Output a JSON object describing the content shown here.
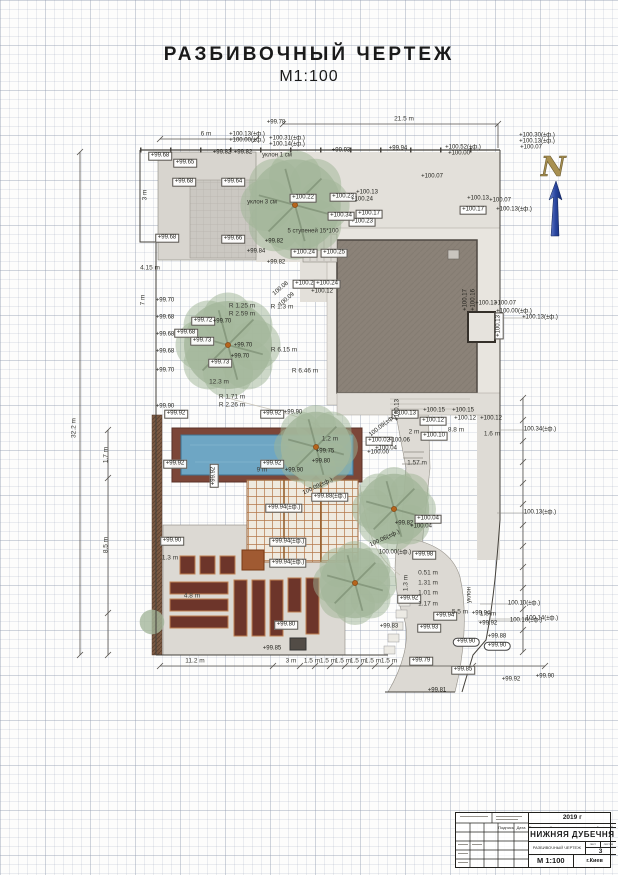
{
  "page": {
    "title_line1": "РАЗБИВОЧНЫЙ  ЧЕРТЕЖ",
    "title_line2": "М1:100"
  },
  "north": {
    "letter": "N"
  },
  "title_block": {
    "year": "2019 г",
    "project": "Благоустройство территории частной усадьбы",
    "object_name": "НИЖНЯЯ ДУБЕЧНЯ",
    "drawing_title": "РАЗБИВОЧНЫЙ ЧЕРТЕЖ",
    "sheet_label": "лист",
    "sheets_label": "листов",
    "sheet_number": "3",
    "scale": "М 1:100",
    "city": "г.Киев",
    "signature_label": "Подпись",
    "date_label": "Дата"
  },
  "trees": [
    {
      "x": 295,
      "y": 205,
      "r": 52
    },
    {
      "x": 228,
      "y": 345,
      "r": 50
    },
    {
      "x": 316,
      "y": 447,
      "r": 40
    },
    {
      "x": 394,
      "y": 509,
      "r": 40
    },
    {
      "x": 355,
      "y": 583,
      "r": 40
    },
    {
      "x": 152,
      "y": 622,
      "r": 14
    }
  ],
  "annotations": [
    {
      "t": "+99.68",
      "x": 160,
      "y": 156,
      "b": 1
    },
    {
      "t": "+99.65",
      "x": 185,
      "y": 163,
      "b": 1
    },
    {
      "t": "+99.68",
      "x": 184,
      "y": 182,
      "b": 1
    },
    {
      "t": "+99.64",
      "x": 233,
      "y": 182,
      "b": 1
    },
    {
      "t": "+99.68",
      "x": 167,
      "y": 238,
      "b": 1
    },
    {
      "t": "+99.66",
      "x": 233,
      "y": 239,
      "b": 1
    },
    {
      "t": "+99.82",
      "x": 222,
      "y": 153
    },
    {
      "t": "+99.82",
      "x": 243,
      "y": 153
    },
    {
      "t": "+99.78",
      "x": 276,
      "y": 123
    },
    {
      "t": "+99.82",
      "x": 274,
      "y": 242
    },
    {
      "t": "+99.84",
      "x": 256,
      "y": 252
    },
    {
      "t": "+99.82",
      "x": 276,
      "y": 263
    },
    {
      "t": "+100.13(±ф.)",
      "x": 247,
      "y": 135
    },
    {
      "t": "+100.00(±ф.)",
      "x": 247,
      "y": 141
    },
    {
      "t": "+100.31(±ф.)",
      "x": 287,
      "y": 139
    },
    {
      "t": "+100.14(±ф.)",
      "x": 287,
      "y": 145
    },
    {
      "t": "+99.93",
      "x": 341,
      "y": 151
    },
    {
      "t": "+99.94",
      "x": 398,
      "y": 149
    },
    {
      "t": "+100.52(±ф.)",
      "x": 463,
      "y": 148
    },
    {
      "t": "+100.00",
      "x": 459,
      "y": 154
    },
    {
      "t": "+100.30(±ф.)",
      "x": 537,
      "y": 136
    },
    {
      "t": "+100.13(±ф.)",
      "x": 537,
      "y": 142
    },
    {
      "t": "+100.07",
      "x": 531,
      "y": 148
    },
    {
      "t": "+100.22",
      "x": 303,
      "y": 198,
      "b": 1
    },
    {
      "t": "+100.23",
      "x": 343,
      "y": 197,
      "b": 1
    },
    {
      "t": "+100.13",
      "x": 367,
      "y": 193
    },
    {
      "t": "+100.24",
      "x": 362,
      "y": 200
    },
    {
      "t": "+100.17",
      "x": 369,
      "y": 214,
      "b": 1
    },
    {
      "t": "+100.23",
      "x": 362,
      "y": 222,
      "b": 1
    },
    {
      "t": "+100.34",
      "x": 341,
      "y": 216,
      "b": 1
    },
    {
      "t": "+100.24",
      "x": 304,
      "y": 253,
      "b": 1
    },
    {
      "t": "+100.25",
      "x": 334,
      "y": 253,
      "b": 1
    },
    {
      "t": "+100.07",
      "x": 432,
      "y": 177
    },
    {
      "t": "+100.13",
      "x": 478,
      "y": 199
    },
    {
      "t": "+100.07",
      "x": 500,
      "y": 201
    },
    {
      "t": "+100.17",
      "x": 473,
      "y": 210,
      "b": 1
    },
    {
      "t": "+100.13(±ф.)",
      "x": 514,
      "y": 210
    },
    {
      "t": "+100.13",
      "x": 486,
      "y": 304
    },
    {
      "t": "+100.07",
      "x": 505,
      "y": 304
    },
    {
      "t": "+100.00(±ф.)",
      "x": 514,
      "y": 312
    },
    {
      "t": "+100.17",
      "x": 466,
      "y": 300,
      "r": -90
    },
    {
      "t": "+100.16",
      "x": 474,
      "y": 300,
      "r": -90
    },
    {
      "t": "+100.13",
      "x": 499,
      "y": 326,
      "r": -90,
      "b": 1
    },
    {
      "t": "+100.13(±ф.)",
      "x": 540,
      "y": 318
    },
    {
      "t": "+99.70",
      "x": 165,
      "y": 301
    },
    {
      "t": "+99.68",
      "x": 165,
      "y": 318
    },
    {
      "t": "+99.68",
      "x": 165,
      "y": 335
    },
    {
      "t": "+99.68",
      "x": 165,
      "y": 352
    },
    {
      "t": "+99.70",
      "x": 165,
      "y": 371
    },
    {
      "t": "+99.72",
      "x": 203,
      "y": 321,
      "b": 1
    },
    {
      "t": "+99.70",
      "x": 222,
      "y": 322
    },
    {
      "t": "+99.68",
      "x": 186,
      "y": 333,
      "b": 1
    },
    {
      "t": "+99.73",
      "x": 202,
      "y": 341,
      "b": 1
    },
    {
      "t": "+99.70",
      "x": 243,
      "y": 346
    },
    {
      "t": "+99.70",
      "x": 240,
      "y": 357
    },
    {
      "t": "+99.73",
      "x": 220,
      "y": 363,
      "b": 1
    },
    {
      "t": "+99.90",
      "x": 165,
      "y": 407
    },
    {
      "t": "+100.23",
      "x": 306,
      "y": 284,
      "b": 1
    },
    {
      "t": "+100.24",
      "x": 327,
      "y": 284,
      "b": 1
    },
    {
      "t": "+100.12",
      "x": 322,
      "y": 292
    },
    {
      "t": "100.08",
      "x": 281,
      "y": 289,
      "r": -40
    },
    {
      "t": "100.09",
      "x": 287,
      "y": 300,
      "r": -40
    },
    {
      "t": "+100.13",
      "x": 405,
      "y": 414,
      "b": 1
    },
    {
      "t": "+100.15",
      "x": 434,
      "y": 411
    },
    {
      "t": "+100.15",
      "x": 463,
      "y": 411
    },
    {
      "t": "+100.12",
      "x": 433,
      "y": 421,
      "b": 1
    },
    {
      "t": "+100.12",
      "x": 465,
      "y": 419
    },
    {
      "t": "+100.12",
      "x": 491,
      "y": 419
    },
    {
      "t": "+100.13",
      "x": 398,
      "y": 410,
      "r": -90
    },
    {
      "t": "+100.10",
      "x": 434,
      "y": 436,
      "b": 1
    },
    {
      "t": "+100.02",
      "x": 379,
      "y": 441,
      "b": 1
    },
    {
      "t": "+100.06",
      "x": 399,
      "y": 441
    },
    {
      "t": "+100.04",
      "x": 386,
      "y": 449
    },
    {
      "t": "+100.00",
      "x": 378,
      "y": 453
    },
    {
      "t": "100.09(±ф.)",
      "x": 383,
      "y": 426,
      "r": -38
    },
    {
      "t": "100.09(±ф.)",
      "x": 318,
      "y": 487,
      "r": -25
    },
    {
      "t": "+99.75",
      "x": 325,
      "y": 452
    },
    {
      "t": "+99.80",
      "x": 321,
      "y": 462
    },
    {
      "t": "+99.90",
      "x": 294,
      "y": 471
    },
    {
      "t": "+99.88(±ф.)",
      "x": 330,
      "y": 497,
      "b": 1
    },
    {
      "t": "+99.94(±ф.)",
      "x": 284,
      "y": 508,
      "b": 1
    },
    {
      "t": "+99.94(±ф.)",
      "x": 288,
      "y": 542,
      "b": 1
    },
    {
      "t": "+99.94(±ф.)",
      "x": 288,
      "y": 563,
      "b": 1
    },
    {
      "t": "+99.82",
      "x": 404,
      "y": 524
    },
    {
      "t": "100.06(±ф.)",
      "x": 385,
      "y": 539,
      "r": -25
    },
    {
      "t": "+100.04",
      "x": 428,
      "y": 519,
      "b": 1
    },
    {
      "t": "+100.04",
      "x": 421,
      "y": 527
    },
    {
      "t": "100.34(±ф.)",
      "x": 540,
      "y": 430
    },
    {
      "t": "100.13(±ф.)",
      "x": 540,
      "y": 513
    },
    {
      "t": "100.14(±ф.)",
      "x": 542,
      "y": 619
    },
    {
      "t": "100.10(±ф.)",
      "x": 524,
      "y": 604
    },
    {
      "t": "100.16(±ф.)",
      "x": 526,
      "y": 621
    },
    {
      "t": "+99.92",
      "x": 176,
      "y": 414,
      "b": 1
    },
    {
      "t": "+99.92",
      "x": 272,
      "y": 414,
      "b": 1
    },
    {
      "t": "+99.90",
      "x": 293,
      "y": 413
    },
    {
      "t": "+99.92",
      "x": 175,
      "y": 464,
      "b": 1
    },
    {
      "t": "+99.92",
      "x": 272,
      "y": 464,
      "b": 1
    },
    {
      "t": "+99.92",
      "x": 214,
      "y": 476,
      "r": -90,
      "b": 1
    },
    {
      "t": "+99.90",
      "x": 172,
      "y": 541,
      "b": 1
    },
    {
      "t": "+99.80",
      "x": 286,
      "y": 625,
      "b": 1
    },
    {
      "t": "+99.85",
      "x": 272,
      "y": 649
    },
    {
      "t": "100.00(±ф.)",
      "x": 395,
      "y": 553
    },
    {
      "t": "+99.98",
      "x": 424,
      "y": 555,
      "b": 1
    },
    {
      "t": "+99.92",
      "x": 409,
      "y": 599,
      "b": 1
    },
    {
      "t": "+99.83",
      "x": 389,
      "y": 627
    },
    {
      "t": "+99.94",
      "x": 445,
      "y": 616,
      "b": 1
    },
    {
      "t": "+99.94",
      "x": 481,
      "y": 614
    },
    {
      "t": "+99.92",
      "x": 488,
      "y": 624
    },
    {
      "t": "+99.93",
      "x": 429,
      "y": 628,
      "b": 1
    },
    {
      "t": "+99.90",
      "x": 466,
      "y": 642,
      "p": 1
    },
    {
      "t": "+99.88",
      "x": 497,
      "y": 637
    },
    {
      "t": "+99.90",
      "x": 497,
      "y": 646,
      "p": 1
    },
    {
      "t": "+99.85",
      "x": 463,
      "y": 670,
      "b": 1
    },
    {
      "t": "+99.92",
      "x": 511,
      "y": 680
    },
    {
      "t": "+99.79",
      "x": 421,
      "y": 661,
      "b": 1
    },
    {
      "t": "+99.81",
      "x": 437,
      "y": 691
    },
    {
      "t": "+99.90",
      "x": 545,
      "y": 677
    },
    {
      "t": "21.5 m",
      "x": 404,
      "y": 119,
      "k": "d"
    },
    {
      "t": "6 m",
      "x": 206,
      "y": 134,
      "k": "d"
    },
    {
      "t": "32.2 m",
      "x": 74,
      "y": 428,
      "k": "d",
      "r": -90
    },
    {
      "t": "4.15 m",
      "x": 150,
      "y": 268,
      "k": "d"
    },
    {
      "t": "7 m",
      "x": 143,
      "y": 300,
      "k": "d",
      "r": -90
    },
    {
      "t": "3 m",
      "x": 145,
      "y": 195,
      "k": "d",
      "r": -90
    },
    {
      "t": "12.3 m",
      "x": 219,
      "y": 382,
      "k": "d"
    },
    {
      "t": "R 1.25 m",
      "x": 242,
      "y": 306,
      "k": "d"
    },
    {
      "t": "R 2.59 m",
      "x": 242,
      "y": 314,
      "k": "d"
    },
    {
      "t": "R 1.3 m",
      "x": 282,
      "y": 307,
      "k": "d"
    },
    {
      "t": "R 6.15 m",
      "x": 284,
      "y": 350,
      "k": "d"
    },
    {
      "t": "R 6.46 m",
      "x": 305,
      "y": 371,
      "k": "d"
    },
    {
      "t": "R 1.71 m",
      "x": 232,
      "y": 397,
      "k": "d"
    },
    {
      "t": "R 2.26 m",
      "x": 232,
      "y": 405,
      "k": "d"
    },
    {
      "t": "9 m",
      "x": 262,
      "y": 470,
      "k": "d"
    },
    {
      "t": "1.2 m",
      "x": 330,
      "y": 439,
      "k": "d"
    },
    {
      "t": "1.7 m",
      "x": 106,
      "y": 455,
      "k": "d",
      "r": -90
    },
    {
      "t": "8.5 m",
      "x": 106,
      "y": 545,
      "k": "d",
      "r": -90
    },
    {
      "t": "11.2 m",
      "x": 195,
      "y": 661,
      "k": "d"
    },
    {
      "t": "3 m",
      "x": 291,
      "y": 661,
      "k": "d"
    },
    {
      "t": "1.5 m",
      "x": 312,
      "y": 661,
      "k": "d"
    },
    {
      "t": "1.5 m",
      "x": 328,
      "y": 661,
      "k": "d"
    },
    {
      "t": "1.5 m",
      "x": 343,
      "y": 661,
      "k": "d"
    },
    {
      "t": "1.5 m",
      "x": 358,
      "y": 661,
      "k": "d"
    },
    {
      "t": "1.5 m",
      "x": 373,
      "y": 661,
      "k": "d"
    },
    {
      "t": "1.5 m",
      "x": 389,
      "y": 661,
      "k": "d"
    },
    {
      "t": "5.5 m",
      "x": 460,
      "y": 612,
      "k": "d"
    },
    {
      "t": "1.6 m",
      "x": 488,
      "y": 614,
      "k": "d"
    },
    {
      "t": "0.51 m",
      "x": 428,
      "y": 573,
      "k": "d"
    },
    {
      "t": "1.31 m",
      "x": 428,
      "y": 583,
      "k": "d"
    },
    {
      "t": "1.01 m",
      "x": 428,
      "y": 593,
      "k": "d"
    },
    {
      "t": "1.17 m",
      "x": 428,
      "y": 604,
      "k": "d"
    },
    {
      "t": "1.3 m",
      "x": 406,
      "y": 583,
      "k": "d",
      "r": -90
    },
    {
      "t": "8.8 m",
      "x": 456,
      "y": 430,
      "k": "d"
    },
    {
      "t": "1.57 m",
      "x": 417,
      "y": 463,
      "k": "d"
    },
    {
      "t": "2 m",
      "x": 414,
      "y": 432,
      "k": "d"
    },
    {
      "t": "4.8 m",
      "x": 192,
      "y": 596,
      "k": "d"
    },
    {
      "t": "1.3 m",
      "x": 170,
      "y": 558,
      "k": "d"
    },
    {
      "t": "1.6 m",
      "x": 492,
      "y": 434,
      "k": "d"
    },
    {
      "t": "уклон 1 см",
      "x": 277,
      "y": 156,
      "k": "n"
    },
    {
      "t": "уклон 3 см",
      "x": 262,
      "y": 203,
      "k": "n"
    },
    {
      "t": "5 ступеней 15*100",
      "x": 313,
      "y": 232,
      "k": "n"
    },
    {
      "t": "уклон",
      "x": 470,
      "y": 595,
      "k": "n",
      "r": -90
    }
  ]
}
